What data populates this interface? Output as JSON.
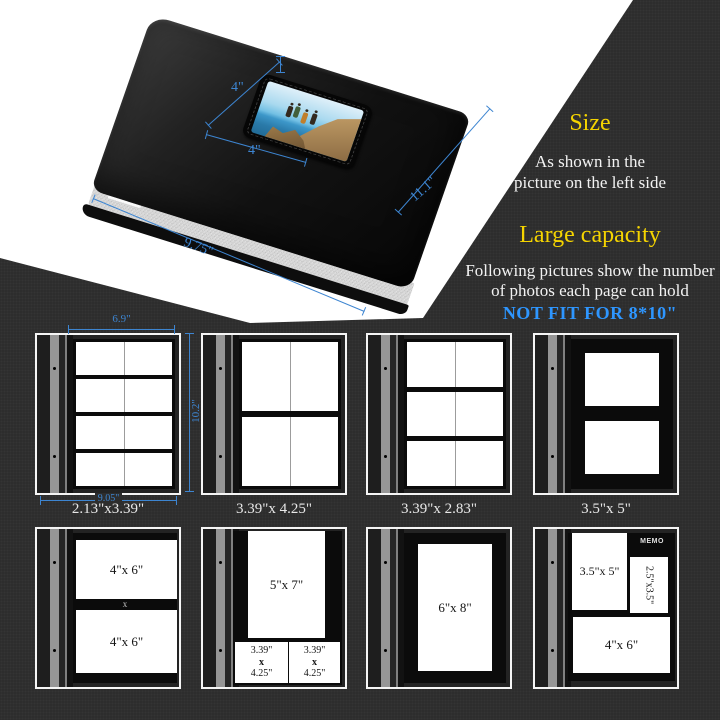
{
  "colors": {
    "background": "#2d2d2d",
    "highlight_yellow": "#f5d400",
    "warning_blue": "#2e96ff",
    "dimension_blue": "#3d85d1"
  },
  "info_panel": {
    "size_title": "Size",
    "size_line1": "As shown in the",
    "size_line2": "picture on the left side",
    "capacity_title": "Large capacity",
    "capacity_line1": "Following pictures show the number",
    "capacity_line2": "of photos each page can hold",
    "warning": "NOT FIT FOR 8*10\""
  },
  "album": {
    "window_width_label": "4\"",
    "window_height_label": "4\"",
    "cover_width_label": "9.75\"",
    "cover_height_label": "11.1\""
  },
  "diagram1": {
    "dim_top": "6.9\"",
    "dim_side": "10.2\"",
    "dim_bottom": "9.05\"",
    "caption": "2.13\"x3.39\""
  },
  "diagram2": {
    "caption": "3.39\"x 4.25\""
  },
  "diagram3": {
    "caption": "3.39\"x 2.83\""
  },
  "diagram4": {
    "caption": "3.5\"x 5\""
  },
  "diagram5": {
    "slot1_label": "4\"x 6\"",
    "divider_label": "x",
    "slot2_label": "4\"x 6\""
  },
  "diagram6": {
    "slot1_label": "5\"x 7\"",
    "slot2_line1": "3.39\"",
    "slot2_line2": "x",
    "slot2_line3": "4.25\"",
    "slot3_line1": "3.39\"",
    "slot3_line2": "x",
    "slot3_line3": "4.25\""
  },
  "diagram7": {
    "slot1_label": "6\"x 8\""
  },
  "diagram8": {
    "slot1_label": "3.5\"x 5\"",
    "memo_label": "MEMO",
    "slot2_label": "2.5\"x3.5\"",
    "slot3_label": "4\"x 6\""
  }
}
